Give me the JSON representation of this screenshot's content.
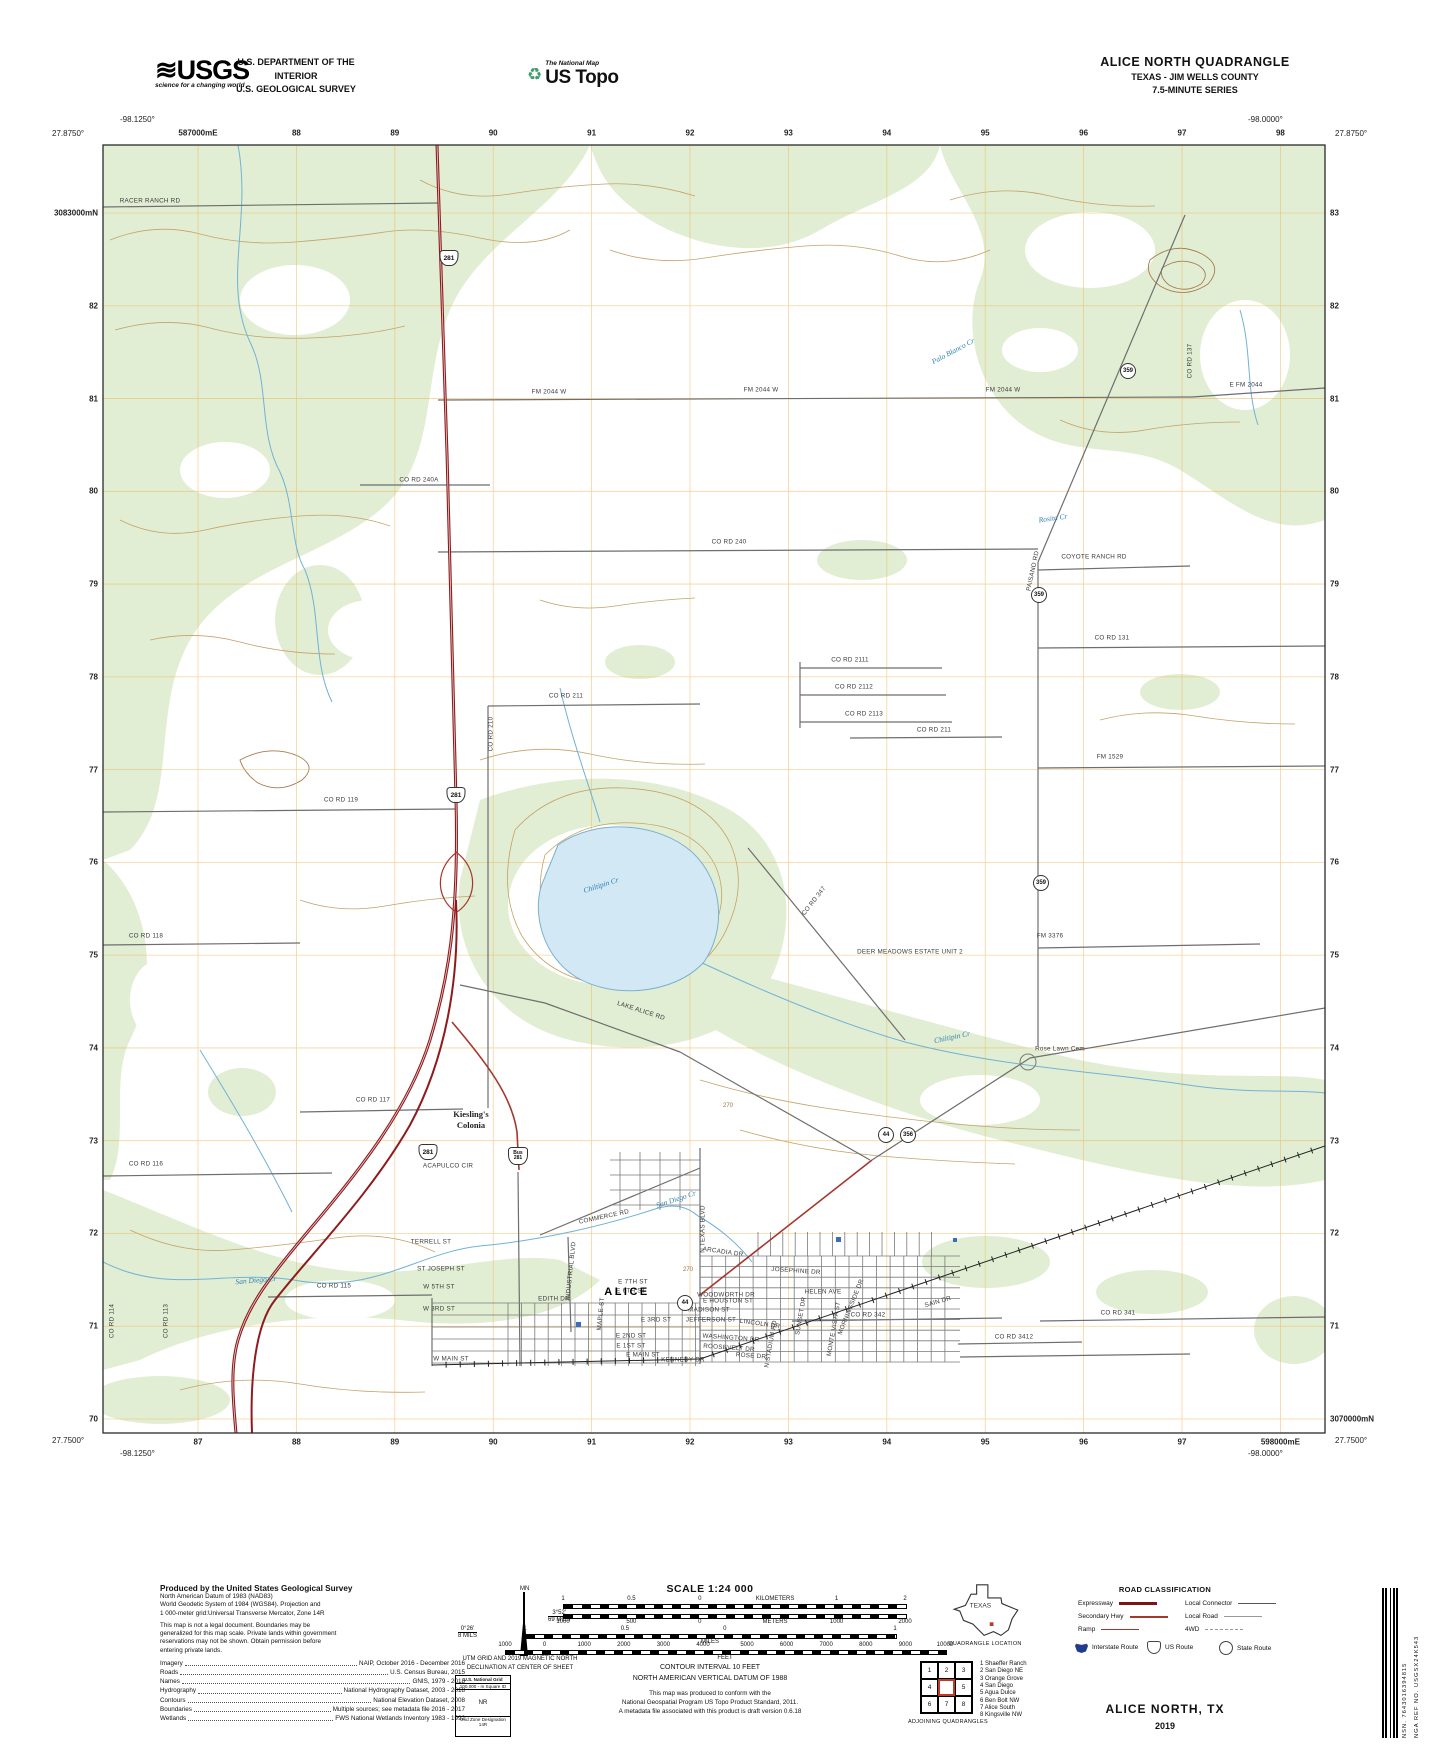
{
  "header": {
    "usgs": "USGS",
    "usgs_wave": "≋",
    "usgs_tagline": "science for a changing world",
    "dept_line1": "U.S. DEPARTMENT OF THE INTERIOR",
    "dept_line2": "U.S. GEOLOGICAL SURVEY",
    "ustopo_small": "The National Map",
    "ustopo_big": "US Topo",
    "recycle_icon": "♻",
    "title1": "ALICE NORTH QUADRANGLE",
    "title2": "TEXAS - JIM WELLS COUNTY",
    "title3": "7.5-MINUTE SERIES"
  },
  "collar": {
    "top_left_lon": "-98.1250°",
    "top_left_lat": "27.8750°",
    "top_right_lon": "-98.0000°",
    "top_right_lat": "27.8750°",
    "bottom_left_lon": "-98.1250°",
    "bottom_left_lat": "27.7500°",
    "bottom_right_lon": "-98.0000°",
    "bottom_right_lat": "27.7500°",
    "top_grid": [
      "587000mE",
      "88",
      "89",
      "90",
      "91",
      "92",
      "93",
      "94",
      "95",
      "96",
      "97",
      "98"
    ],
    "bottom_grid": [
      "87",
      "88",
      "89",
      "90",
      "91",
      "92",
      "93",
      "94",
      "95",
      "96",
      "97",
      "598000mE"
    ],
    "left_grid": [
      "3083000mN",
      "82",
      "81",
      "80",
      "79",
      "78",
      "77",
      "76",
      "75",
      "74",
      "73",
      "72",
      "71",
      "70"
    ],
    "right_grid": [
      "83",
      "82",
      "81",
      "80",
      "79",
      "78",
      "77",
      "76",
      "75",
      "74",
      "73",
      "72",
      "71",
      "3070000mN"
    ]
  },
  "map": {
    "labels": [
      {
        "t": "RACER RANCH RD",
        "x": 150,
        "y": 201,
        "c": "road"
      },
      {
        "t": "FM 2044 W",
        "x": 549,
        "y": 392,
        "c": "road"
      },
      {
        "t": "FM 2044 W",
        "x": 761,
        "y": 390,
        "c": "road"
      },
      {
        "t": "FM 2044 W",
        "x": 1003,
        "y": 390,
        "c": "road"
      },
      {
        "t": "E FM 2044",
        "x": 1246,
        "y": 385,
        "c": "road"
      },
      {
        "t": "CO RD 240A",
        "x": 419,
        "y": 480,
        "c": "road"
      },
      {
        "t": "CO RD 240",
        "x": 729,
        "y": 542,
        "c": "road"
      },
      {
        "t": "COYOTE RANCH RD",
        "x": 1094,
        "y": 557,
        "c": "road"
      },
      {
        "t": "CO RD 131",
        "x": 1112,
        "y": 638,
        "c": "road"
      },
      {
        "t": "CO RD 2111",
        "x": 850,
        "y": 660,
        "c": "road"
      },
      {
        "t": "CO RD 2112",
        "x": 854,
        "y": 687,
        "c": "road"
      },
      {
        "t": "CO RD 2113",
        "x": 864,
        "y": 714,
        "c": "road"
      },
      {
        "t": "CO RD 211",
        "x": 566,
        "y": 696,
        "c": "road"
      },
      {
        "t": "CO RD 211",
        "x": 934,
        "y": 730,
        "c": "road"
      },
      {
        "t": "CO RD 210",
        "x": 491,
        "y": 734,
        "c": "road",
        "r": -90
      },
      {
        "t": "FM 1529",
        "x": 1110,
        "y": 757,
        "c": "road"
      },
      {
        "t": "CO RD 119",
        "x": 341,
        "y": 800,
        "c": "road"
      },
      {
        "t": "CO RD 118",
        "x": 146,
        "y": 936,
        "c": "road"
      },
      {
        "t": "CO RD 117",
        "x": 373,
        "y": 1100,
        "c": "road"
      },
      {
        "t": "CO RD 116",
        "x": 146,
        "y": 1164,
        "c": "road"
      },
      {
        "t": "CO RD 115",
        "x": 334,
        "y": 1286,
        "c": "road"
      },
      {
        "t": "CO RD 114",
        "x": 112,
        "y": 1321,
        "c": "road",
        "r": -90
      },
      {
        "t": "CO RD 113",
        "x": 166,
        "y": 1321,
        "c": "road",
        "r": -90
      },
      {
        "t": "CO RD 347",
        "x": 814,
        "y": 901,
        "c": "road",
        "r": -52
      },
      {
        "t": "LAKE ALICE RD",
        "x": 641,
        "y": 1011,
        "c": "road",
        "r": 18
      },
      {
        "t": "FM 3376",
        "x": 1050,
        "y": 936,
        "c": "road"
      },
      {
        "t": "PAISANO RD",
        "x": 1033,
        "y": 571,
        "c": "road",
        "r": -78
      },
      {
        "t": "CO RD 137",
        "x": 1190,
        "y": 361,
        "c": "road",
        "r": -90
      },
      {
        "t": "COMMERCE RD",
        "x": 604,
        "y": 1217,
        "c": "road",
        "r": -12
      },
      {
        "t": "N TEXAS BLVD",
        "x": 703,
        "y": 1229,
        "c": "road",
        "r": -90
      },
      {
        "t": "INDUSTRIAL BLVD",
        "x": 571,
        "y": 1271,
        "c": "road",
        "r": -84
      },
      {
        "t": "EDITH DR",
        "x": 554,
        "y": 1299,
        "c": "road"
      },
      {
        "t": "ACAPULCO CIR",
        "x": 448,
        "y": 1166,
        "c": "road"
      },
      {
        "t": "ARCADIA DR",
        "x": 723,
        "y": 1252,
        "c": "road",
        "r": 8
      },
      {
        "t": "WOODWORTH DR",
        "x": 726,
        "y": 1295,
        "c": "road"
      },
      {
        "t": "MADISON ST",
        "x": 709,
        "y": 1310,
        "c": "road"
      },
      {
        "t": "JEFFERSON ST",
        "x": 711,
        "y": 1320,
        "c": "road"
      },
      {
        "t": "LINCOLN DR",
        "x": 760,
        "y": 1324,
        "c": "road",
        "r": 8
      },
      {
        "t": "WASHINGTON DR",
        "x": 731,
        "y": 1338,
        "c": "road",
        "r": 4
      },
      {
        "t": "ROOSEVELT DR",
        "x": 729,
        "y": 1348,
        "c": "road",
        "r": 4
      },
      {
        "t": "ROSE DR",
        "x": 751,
        "y": 1356,
        "c": "road",
        "r": 4
      },
      {
        "t": "KENNEDY DR",
        "x": 683,
        "y": 1360,
        "c": "road"
      },
      {
        "t": "HELEN AVE",
        "x": 823,
        "y": 1292,
        "c": "road"
      },
      {
        "t": "SUNSET DR",
        "x": 801,
        "y": 1316,
        "c": "road",
        "r": -80
      },
      {
        "t": "MONTE VISTA ST",
        "x": 834,
        "y": 1329,
        "c": "road",
        "r": -80
      },
      {
        "t": "MORNINGSIDE DR",
        "x": 851,
        "y": 1307,
        "c": "road",
        "r": -68
      },
      {
        "t": "N STADIUM RD",
        "x": 771,
        "y": 1344,
        "c": "road",
        "r": -80
      },
      {
        "t": "MAPLE ST",
        "x": 601,
        "y": 1314,
        "c": "road",
        "r": -84
      },
      {
        "t": "TERRELL ST",
        "x": 431,
        "y": 1242,
        "c": "road"
      },
      {
        "t": "ST JOSEPH ST",
        "x": 441,
        "y": 1269,
        "c": "road"
      },
      {
        "t": "W 5TH ST",
        "x": 439,
        "y": 1287,
        "c": "road"
      },
      {
        "t": "W 3RD ST",
        "x": 439,
        "y": 1309,
        "c": "road"
      },
      {
        "t": "W MAIN ST",
        "x": 451,
        "y": 1359,
        "c": "road"
      },
      {
        "t": "E 7TH ST",
        "x": 633,
        "y": 1282,
        "c": "road"
      },
      {
        "t": "E 6TH ST",
        "x": 631,
        "y": 1291,
        "c": "road"
      },
      {
        "t": "E 3RD ST",
        "x": 656,
        "y": 1320,
        "c": "road"
      },
      {
        "t": "E 2ND ST",
        "x": 631,
        "y": 1336,
        "c": "road"
      },
      {
        "t": "E 1ST ST",
        "x": 631,
        "y": 1346,
        "c": "road"
      },
      {
        "t": "E MAIN ST",
        "x": 643,
        "y": 1355,
        "c": "road"
      },
      {
        "t": "E HOUSTON ST",
        "x": 728,
        "y": 1301,
        "c": "road"
      },
      {
        "t": "JOSEPHINE DR",
        "x": 796,
        "y": 1271,
        "c": "road",
        "r": 4
      },
      {
        "t": "SAIN DR",
        "x": 938,
        "y": 1302,
        "c": "road",
        "r": -16
      },
      {
        "t": "CO RD 342",
        "x": 868,
        "y": 1315,
        "c": "road"
      },
      {
        "t": "CO RD 341",
        "x": 1118,
        "y": 1313,
        "c": "road"
      },
      {
        "t": "CO RD 3412",
        "x": 1014,
        "y": 1337,
        "c": "road"
      },
      {
        "t": "Rose Lawn Cem",
        "x": 1060,
        "y": 1049,
        "c": "road"
      },
      {
        "t": "DEER MEADOWS ESTATE UNIT 2",
        "x": 910,
        "y": 952,
        "c": "road"
      },
      {
        "t": "Rosita Cr",
        "x": 1053,
        "y": 518,
        "c": "creek",
        "r": -8
      },
      {
        "t": "Chiltipin Cr",
        "x": 601,
        "y": 885,
        "c": "creek",
        "r": -18
      },
      {
        "t": "Chiltipin Cr",
        "x": 952,
        "y": 1037,
        "c": "creek",
        "r": -12
      },
      {
        "t": "San Diego Cr",
        "x": 676,
        "y": 1199,
        "c": "creek",
        "r": -18
      },
      {
        "t": "San Diego Cr",
        "x": 256,
        "y": 1280,
        "c": "creek",
        "r": -5
      },
      {
        "t": "Palo Blanco Cr",
        "x": 953,
        "y": 351,
        "c": "creek",
        "r": -28
      },
      {
        "t": "Kiesling's",
        "x": 471,
        "y": 1114,
        "c": "place"
      },
      {
        "t": "Colonia",
        "x": 471,
        "y": 1125,
        "c": "place"
      },
      {
        "t": "ALICE",
        "x": 627,
        "y": 1292,
        "c": "city"
      },
      {
        "t": "270",
        "x": 688,
        "y": 1270,
        "c": "contour"
      },
      {
        "t": "270",
        "x": 728,
        "y": 1106,
        "c": "contour"
      }
    ],
    "shields": [
      {
        "type": "us",
        "t": "281",
        "x": 449,
        "y": 258
      },
      {
        "type": "us",
        "t": "281",
        "x": 456,
        "y": 795
      },
      {
        "type": "us",
        "t": "281",
        "x": 428,
        "y": 1152
      },
      {
        "type": "bus",
        "t": "Bus",
        "t2": "281",
        "x": 518,
        "y": 1156
      },
      {
        "type": "circ",
        "t": "359",
        "x": 1128,
        "y": 371
      },
      {
        "type": "circ",
        "t": "359",
        "x": 1039,
        "y": 595
      },
      {
        "type": "circ",
        "t": "359",
        "x": 1041,
        "y": 883
      },
      {
        "type": "circ",
        "t": "44",
        "x": 886,
        "y": 1135
      },
      {
        "type": "circ",
        "t": "356",
        "x": 908,
        "y": 1135
      },
      {
        "type": "circ",
        "t": "44",
        "x": 685,
        "y": 1303
      }
    ]
  },
  "footer": {
    "produced_by": "Produced by the United States Geological Survey",
    "datum_lines": [
      "North American Datum of 1983 (NAD83)",
      "World Geodetic System of 1984 (WGS84).  Projection and",
      "1 000-meter grid:Universal Transverse Mercator, Zone 14R"
    ],
    "legal_lines": [
      "This map is not a legal document. Boundaries may be",
      "generalized for this map scale. Private lands within government",
      "reservations may not be shown. Obtain permission before",
      "entering private lands."
    ],
    "sources": [
      {
        "k": "Imagery",
        "v": "NAIP, October 2016 - December 2016"
      },
      {
        "k": "Roads",
        "v": "U.S. Census Bureau, 2015"
      },
      {
        "k": "Names",
        "v": "GNIS, 1979 - 2018"
      },
      {
        "k": "Hydrography",
        "v": "National Hydrography Dataset, 2003 - 2018"
      },
      {
        "k": "Contours",
        "v": "National Elevation Dataset, 2008"
      },
      {
        "k": "Boundaries",
        "v": "Multiple sources; see metadata file 2016 - 2017"
      },
      {
        "k": "Wetlands",
        "v": "FWS National Wetlands Inventory 1983 - 1992"
      }
    ],
    "declination": {
      "mn": "MN",
      "gn_deg": "0°26'",
      "gn_mils": "8 MILS",
      "mn_deg": "3°52'",
      "mn_mils": "69 MILS",
      "caption1": "UTM GRID AND 2019 MAGNETIC NORTH",
      "caption2": "DECLINATION AT CENTER OF SHEET"
    },
    "usng": {
      "title": "U.S. National Grid",
      "sub": "100,000 - m Square ID",
      "square": "NR",
      "zone_label": "Grid Zone Designation",
      "zone": "14R"
    },
    "scale_title": "SCALE 1:24 000",
    "bars": {
      "km": {
        "labels": [
          [
            "1",
            0
          ],
          [
            "0.5",
            0.2
          ],
          [
            "0",
            0.4
          ],
          [
            "KILOMETERS",
            0.62
          ],
          [
            "1",
            0.8
          ],
          [
            "2",
            1
          ]
        ]
      },
      "m": {
        "labels": [
          [
            "1000",
            0
          ],
          [
            "500",
            0.2
          ],
          [
            "0",
            0.4
          ],
          [
            "METERS",
            0.62
          ],
          [
            "1000",
            0.8
          ],
          [
            "2000",
            1
          ]
        ]
      },
      "mi": {
        "labels": [
          [
            "1",
            0
          ],
          [
            "0.5",
            0.27
          ],
          [
            "0",
            0.54
          ],
          [
            "1",
            1
          ]
        ],
        "unit": "MILES"
      },
      "ft": {
        "labels": [
          [
            "1000",
            0
          ],
          [
            "0",
            0.09
          ],
          [
            "1000",
            0.18
          ],
          [
            "2000",
            0.27
          ],
          [
            "3000",
            0.36
          ],
          [
            "4000",
            0.45
          ],
          [
            "5000",
            0.55
          ],
          [
            "6000",
            0.64
          ],
          [
            "7000",
            0.73
          ],
          [
            "8000",
            0.82
          ],
          [
            "9000",
            0.91
          ],
          [
            "10000",
            1
          ]
        ],
        "unit": "FEET"
      }
    },
    "contour_line1": "CONTOUR INTERVAL 10 FEET",
    "contour_line2": "NORTH AMERICAN VERTICAL DATUM OF 1988",
    "standard_lines": [
      "This map was produced to conform with the",
      "National Geospatial Program US Topo Product Standard, 2011.",
      "A metadata file associated with this product is draft version 0.6.18"
    ],
    "quad_location": {
      "state": "TEXAS",
      "caption": "QUADRANGLE LOCATION"
    },
    "adjoining": {
      "caption": "ADJOINING QUADRANGLES",
      "cells": [
        "1",
        "2",
        "3",
        "4",
        "",
        "5",
        "6",
        "7",
        "8"
      ],
      "list": [
        "1 Shaeffer Ranch",
        "2 San Diego NE",
        "3 Orange Grove",
        "4 San Diego",
        "5 Agua Dulce",
        "6 Ben Bolt NW",
        "7 Alice South",
        "8 Kingsville NW"
      ]
    },
    "road_class": {
      "title": "ROAD CLASSIFICATION",
      "left_rows": [
        "Expressway",
        "Secondary Hwy",
        "Ramp"
      ],
      "right_rows": [
        "Local Connector",
        "Local Road",
        "4WD"
      ],
      "shield_rows": [
        "Interstate Route",
        "US Route",
        "State Route"
      ]
    },
    "map_name": "ALICE NORTH,  TX",
    "year": "2019",
    "barcode_nsn": "NSN.  7643016394815",
    "barcode_nga": "NGA REF NO.  USGSX24K543"
  }
}
